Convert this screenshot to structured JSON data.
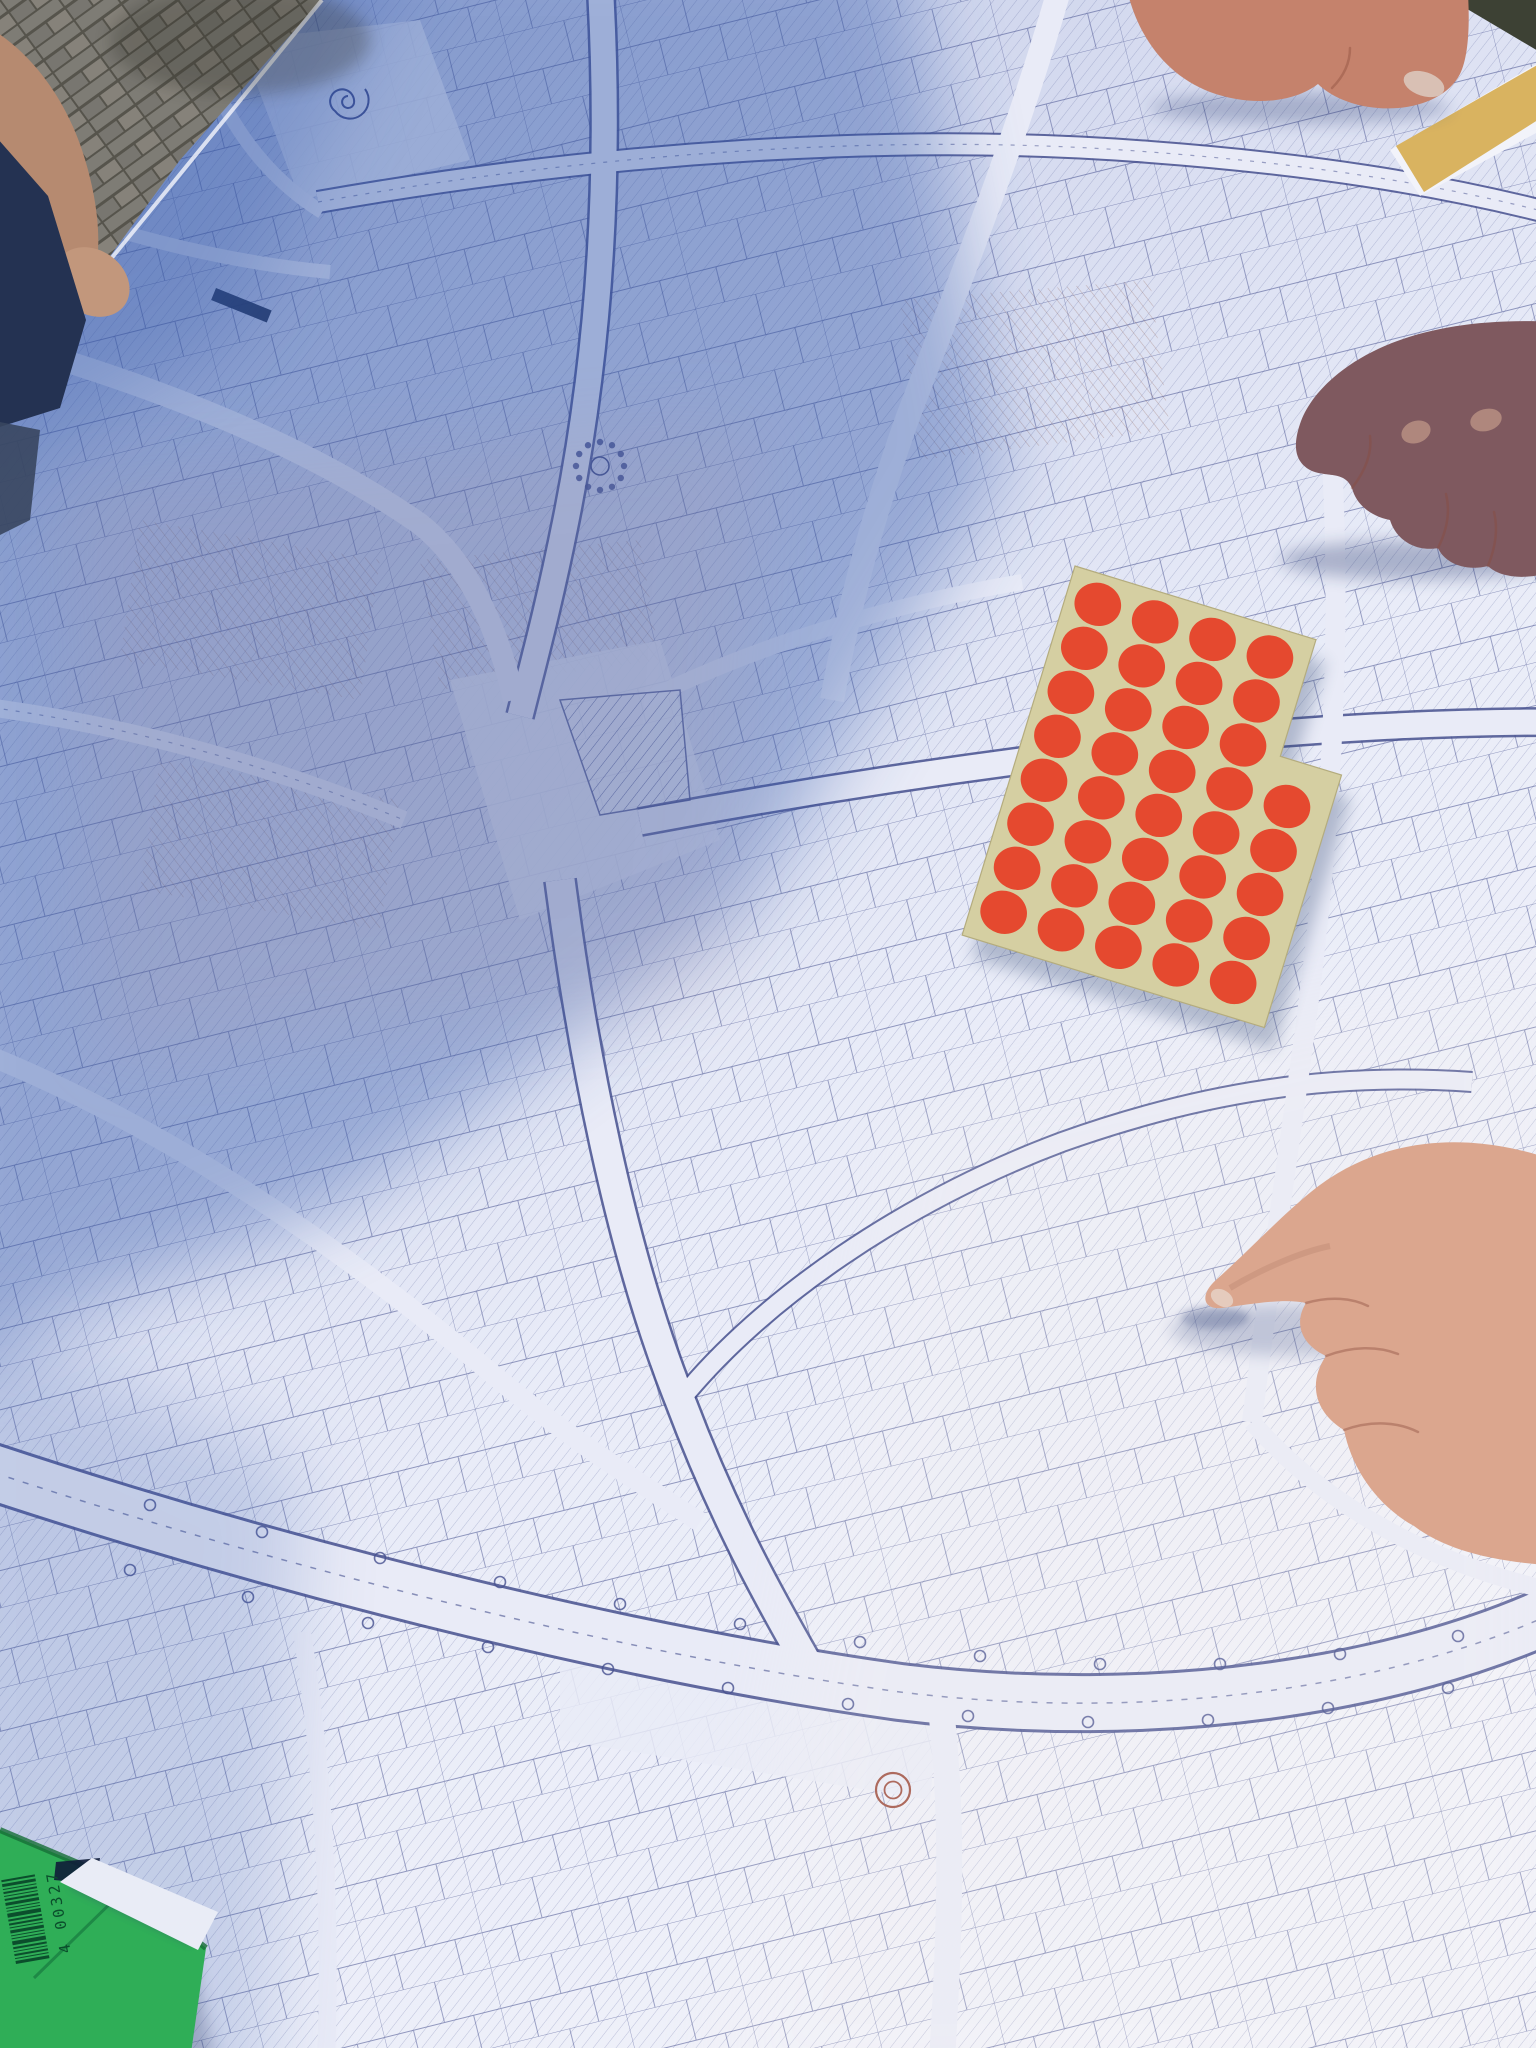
{
  "colors": {
    "paper_light": "#e9ebf7",
    "paper_mid": "#ccd4ec",
    "paper_shadow": "#8fa3d4",
    "line_main": "#46508e",
    "line_soft": "#6a71a8",
    "line_sepia": "#9a6150",
    "shadow_blue": "#2f54a8",
    "sticker_sheet": "#d5cfa2",
    "sticker_dot": "#e5492f",
    "green_folder": "#2fae57",
    "green_folder_edge": "#176e37",
    "barcode": "#0b4e2c",
    "pavement": "#7d7b74",
    "pavement_joint": "#56544c",
    "ground_dark": "#3d4134",
    "table_edge": "#d9b360",
    "skin_light": "#dba68e",
    "skin_mid": "#c5826c",
    "skin_shadow": "#8f5e55",
    "nail": "#d9c0b4"
  },
  "map": {
    "paper_color": "#e9ebf7",
    "line_color": "#46508e",
    "shadow_color": "#2f54a8",
    "roundabout_color": "#a2564a"
  },
  "sticker_sheet": {
    "rows": 8,
    "columns": 5,
    "dots_per_row": [
      4,
      4,
      4,
      5,
      5,
      5,
      5,
      5
    ],
    "total_dots": 37,
    "dot_color": "#e5492f",
    "sheet_color": "#d5cfa2",
    "rotation_deg": 17
  },
  "green_folder": {
    "color": "#2fae57",
    "barcode_digits": "4 00327",
    "barcode_color": "#0b4e2c"
  },
  "hands": {
    "top_right": "resting-hand-with-thumb",
    "middle_right": "shadowed-fist",
    "bottom_right": "pointing-knuckle-hand"
  }
}
